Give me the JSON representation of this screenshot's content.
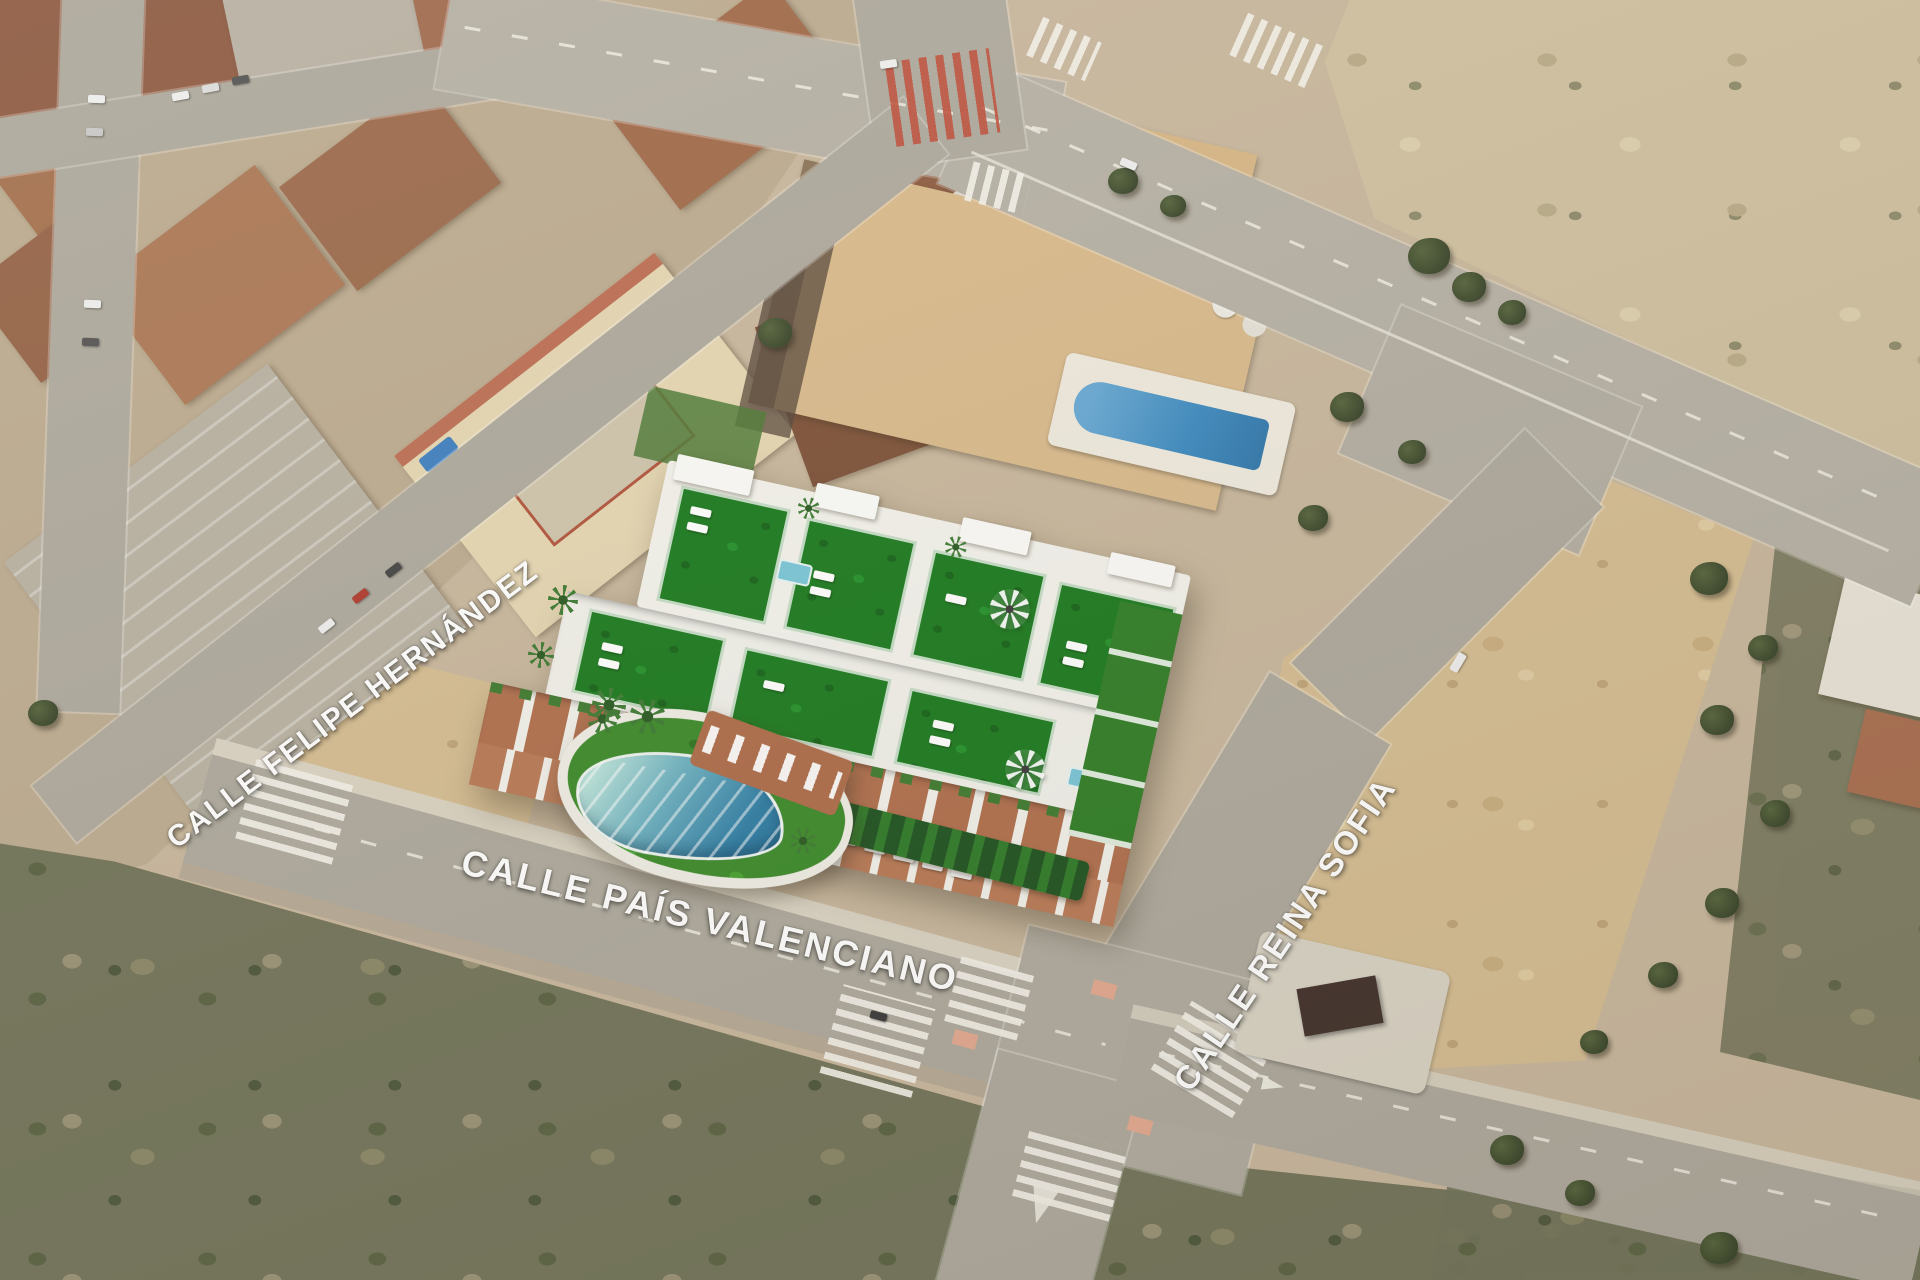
{
  "map": {
    "type": "aerial-development-location-map",
    "street_labels": [
      {
        "id": "calle-felipe-hernandez",
        "label": "CALLE FELIPE HERNÁNDEZ"
      },
      {
        "id": "calle-pais-valenciano",
        "label": "CALLE PAÍS VALENCIANO"
      },
      {
        "id": "calle-reina-sofia",
        "label": "CALLE REINA SOFIA"
      }
    ],
    "palette": {
      "ground_sand": "#c8b79d",
      "dirt_lot": "#d5bd92",
      "road_gray": "#aea99d",
      "scrub_olive": "#72745a",
      "roof_terracotta": "#a96e50",
      "roof_gray_warehouse": "#b8b1a2",
      "cream_building": "#e5d6b2",
      "townhouse_tan": "#d9ba8c",
      "townhouse_pool_blue": "#4794c8",
      "render_white": "#f3f2ec",
      "render_turf_green": "#1b7a1e",
      "render_lawn_green": "#3b8a29",
      "render_deck_brick": "#b06f4d",
      "render_pool_aqua": "#b9e2da",
      "render_pool_blue": "#2e7da5",
      "tree_green": "#39452a",
      "crosswalk_red": "#bf4f3c",
      "label_white": "#ffffff"
    }
  }
}
